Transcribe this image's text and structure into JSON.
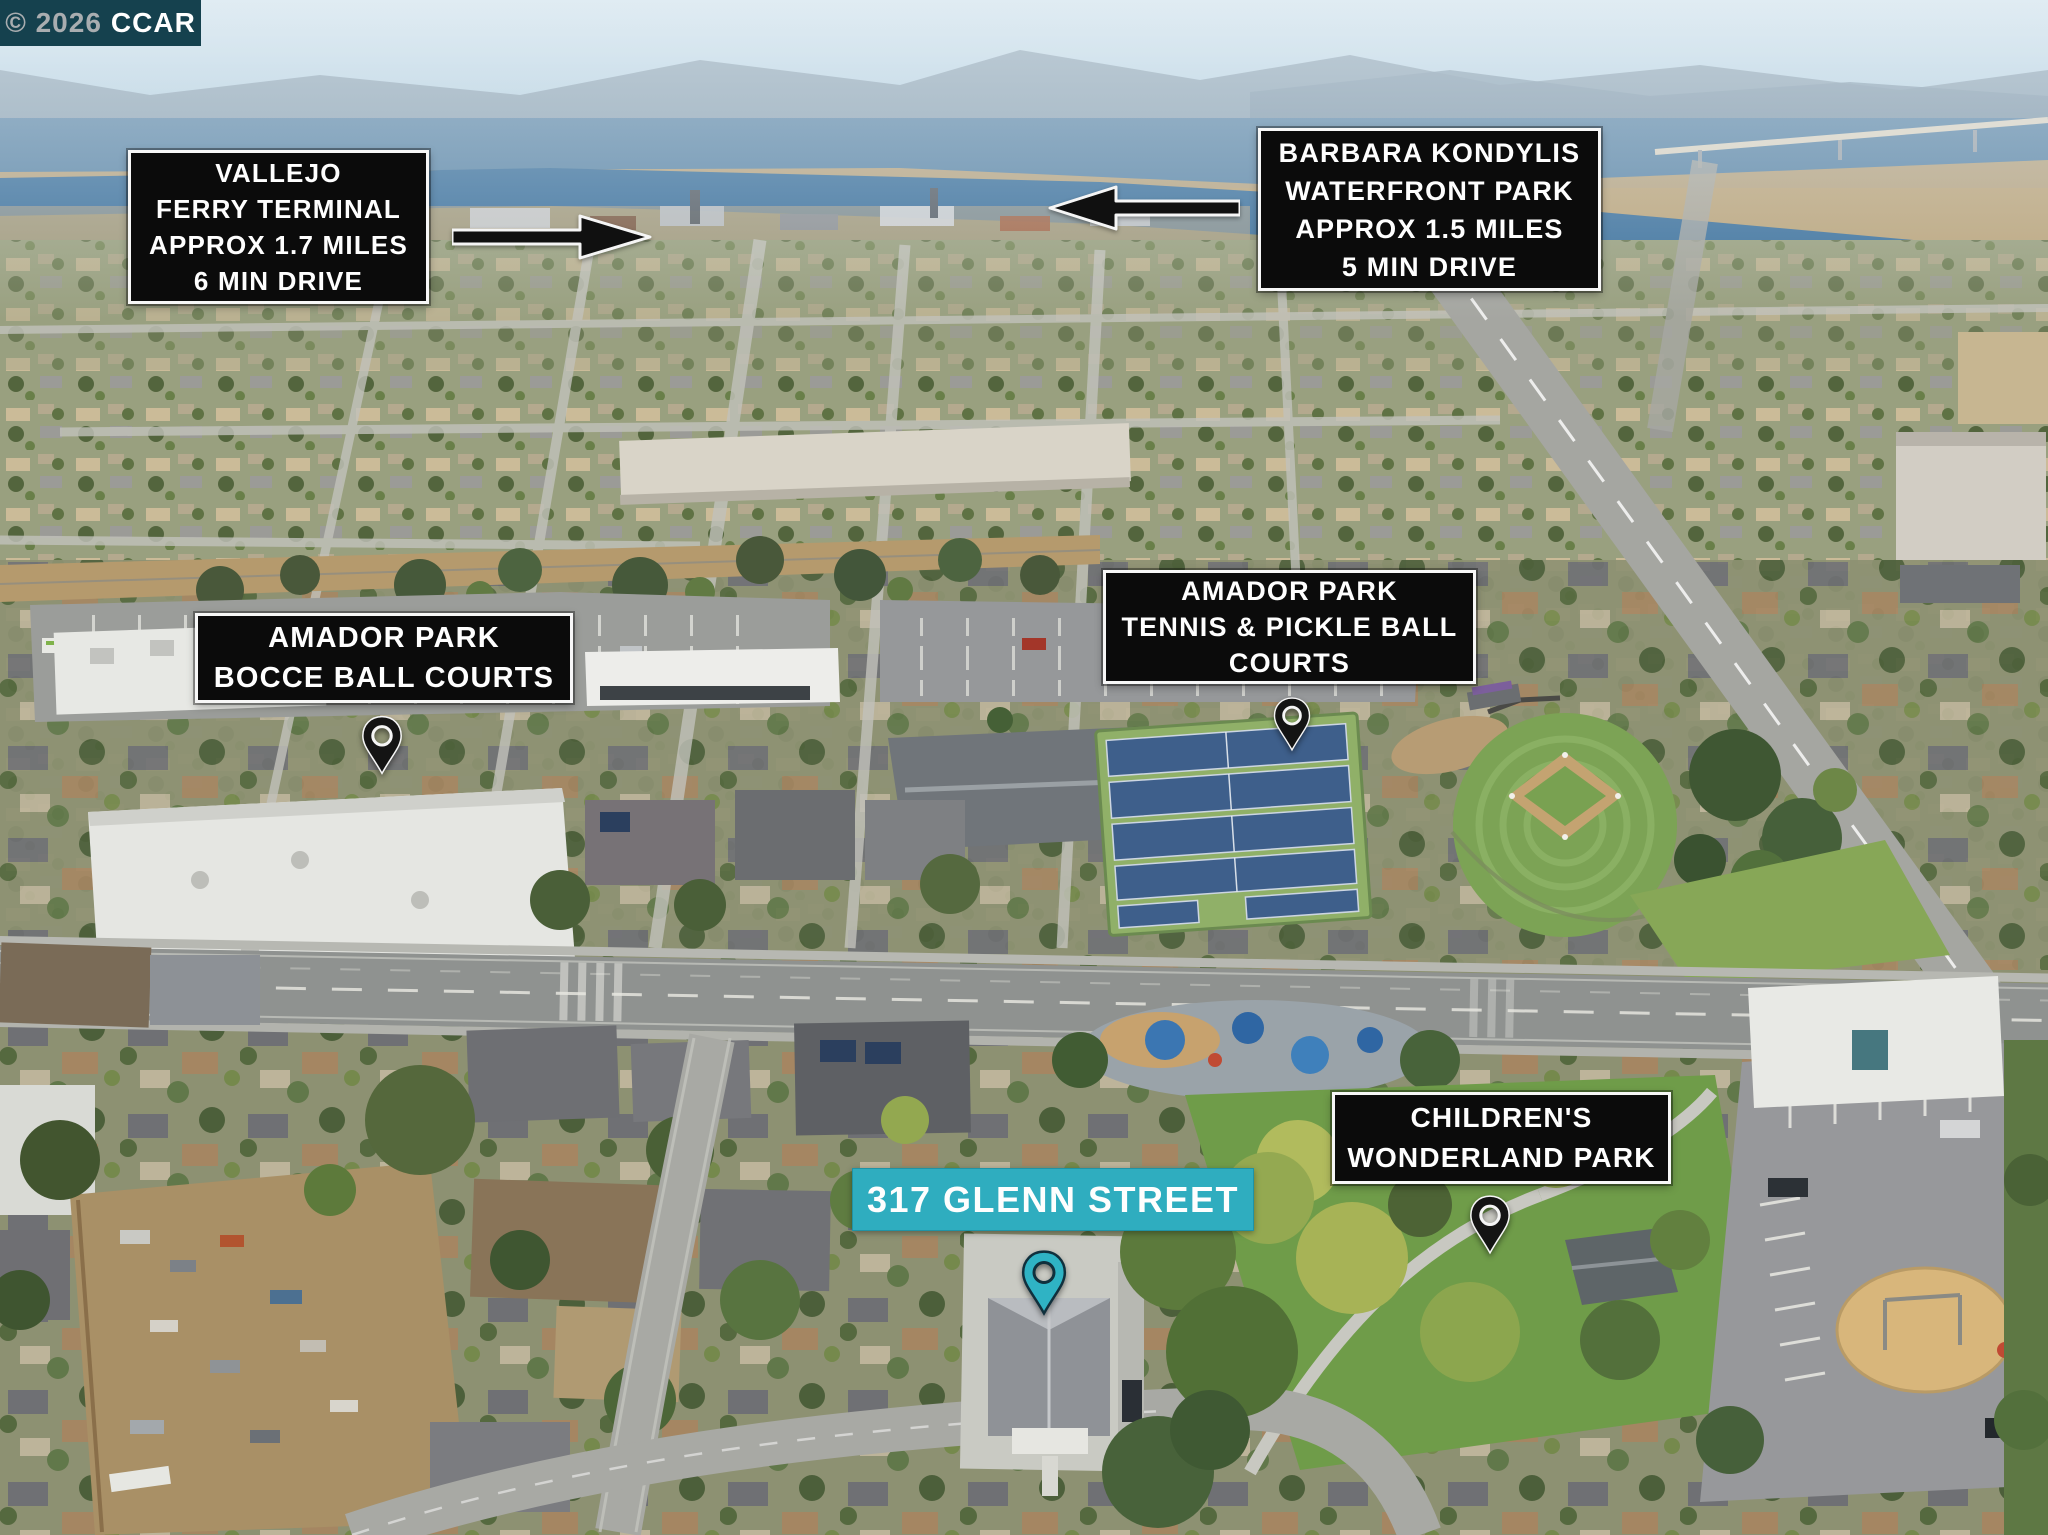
{
  "image_type": "aerial-drone-photo-with-location-annotations",
  "watermark": {
    "copyright_year": "© 2026",
    "brand": "CCAR"
  },
  "labels": {
    "vallejo_ferry": {
      "lines": [
        "VALLEJO",
        "FERRY TERMINAL",
        "APPROX 1.7 MILES",
        "6 MIN DRIVE"
      ],
      "arrow": "right"
    },
    "barbara_kondylis": {
      "lines": [
        "BARBARA KONDYLIS",
        "WATERFRONT PARK",
        "APPROX 1.5 MILES",
        "5 MIN DRIVE"
      ],
      "arrow": "left"
    },
    "amador_bocce": {
      "lines": [
        "AMADOR PARK",
        "BOCCE BALL COURTS"
      ],
      "marker": "dark-map-pin"
    },
    "amador_tennis": {
      "lines": [
        "AMADOR PARK",
        "TENNIS & PICKLE BALL",
        "COURTS"
      ],
      "marker": "dark-map-pin"
    },
    "childrens_wonderland": {
      "lines": [
        "CHILDREN'S",
        "WONDERLAND PARK"
      ],
      "marker": "dark-map-pin"
    },
    "subject_property": {
      "lines": [
        "317 GLENN STREET"
      ],
      "marker": "teal-map-pin"
    }
  },
  "colors": {
    "label_bg": "#0b0b0b",
    "label_border": "#f7f7f7",
    "label_text": "#ffffff",
    "accent_teal": "#2fadbf",
    "pin_dark": "#141414",
    "pin_teal": "#2fb3c4",
    "watermark_bg": "#15414e"
  }
}
